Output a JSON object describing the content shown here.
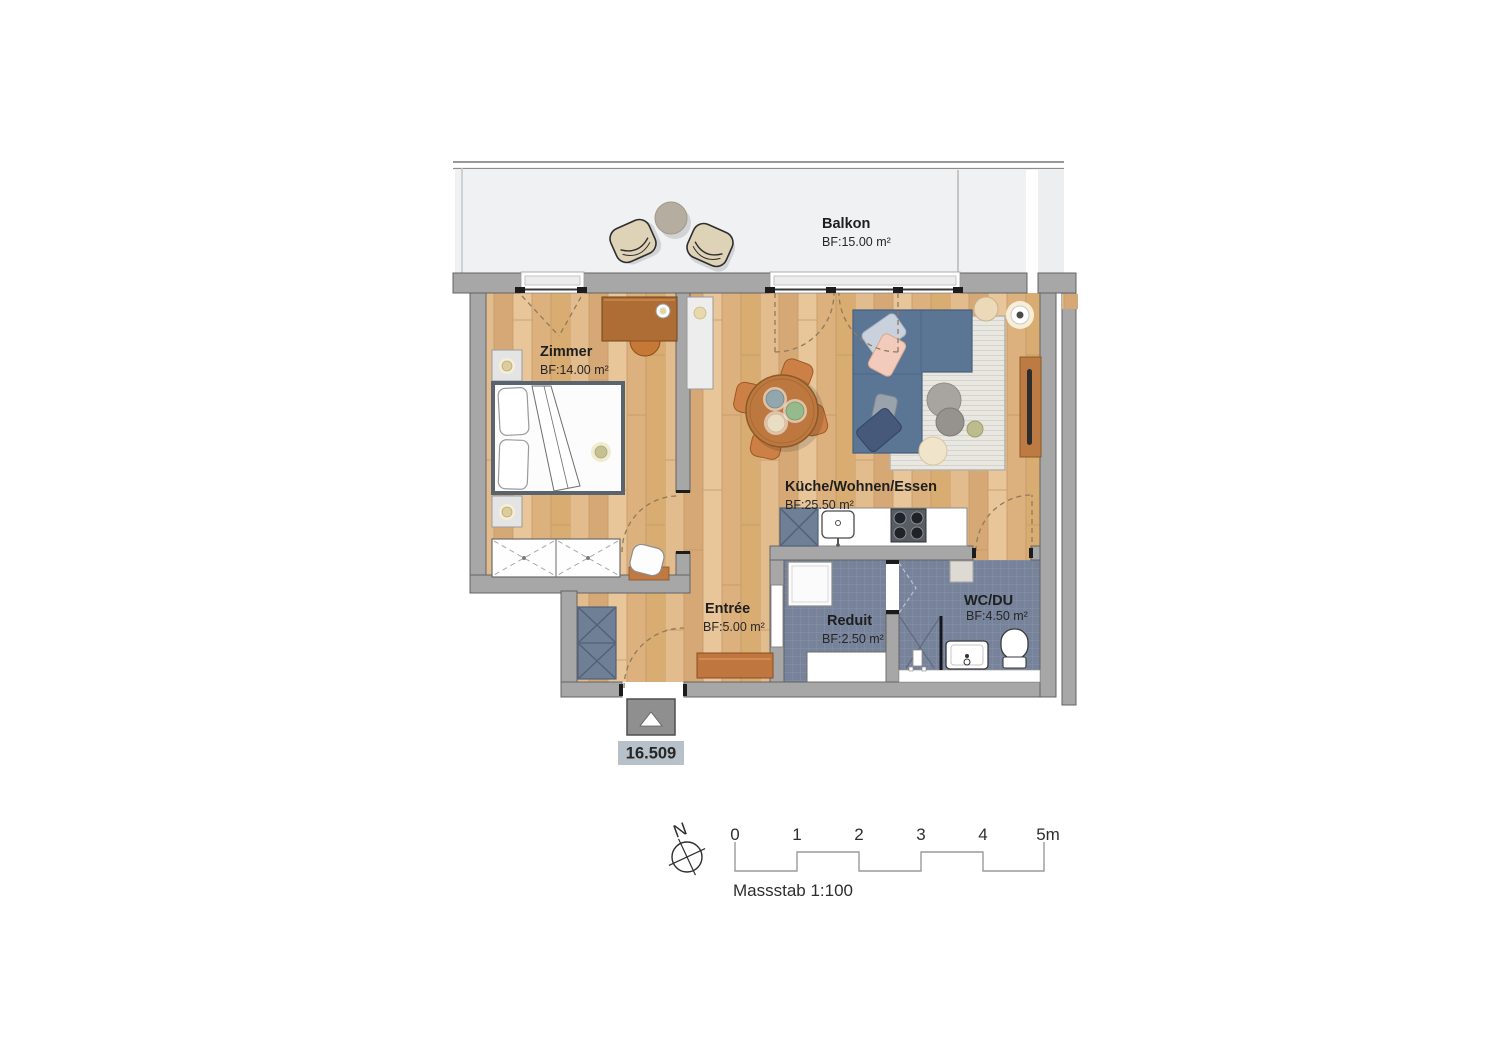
{
  "rooms": {
    "balkon": {
      "name": "Balkon",
      "area": "BF:15.00 m²"
    },
    "zimmer": {
      "name": "Zimmer",
      "area": "BF:14.00 m²"
    },
    "kueche_wohnen_essen": {
      "name": "Küche/Wohnen/Essen",
      "area": "BF:25.50 m²"
    },
    "entree": {
      "name": "Entrée",
      "area": "BF:5.00 m²"
    },
    "reduit": {
      "name": "Reduit",
      "area": "BF:2.50 m²"
    },
    "wc_du": {
      "name": "WC/DU",
      "area": "BF:4.50 m²"
    }
  },
  "unit_number": "16.509",
  "compass": {
    "north_label": "N"
  },
  "scalebar": {
    "labels": [
      "0",
      "1",
      "2",
      "3",
      "4",
      "5m"
    ],
    "caption": "Massstab 1:100"
  },
  "colors": {
    "wood_floor": "#dfb283",
    "wall": "#a7a7a7",
    "tile_floor": "#77839a",
    "sofa": "#5b7594",
    "balcony_floor": "#f0f1f3",
    "cabinet_blue": "#6f7f95",
    "unit_label_bg": "#b6c1ca",
    "accent_wood": "#c0763f"
  }
}
